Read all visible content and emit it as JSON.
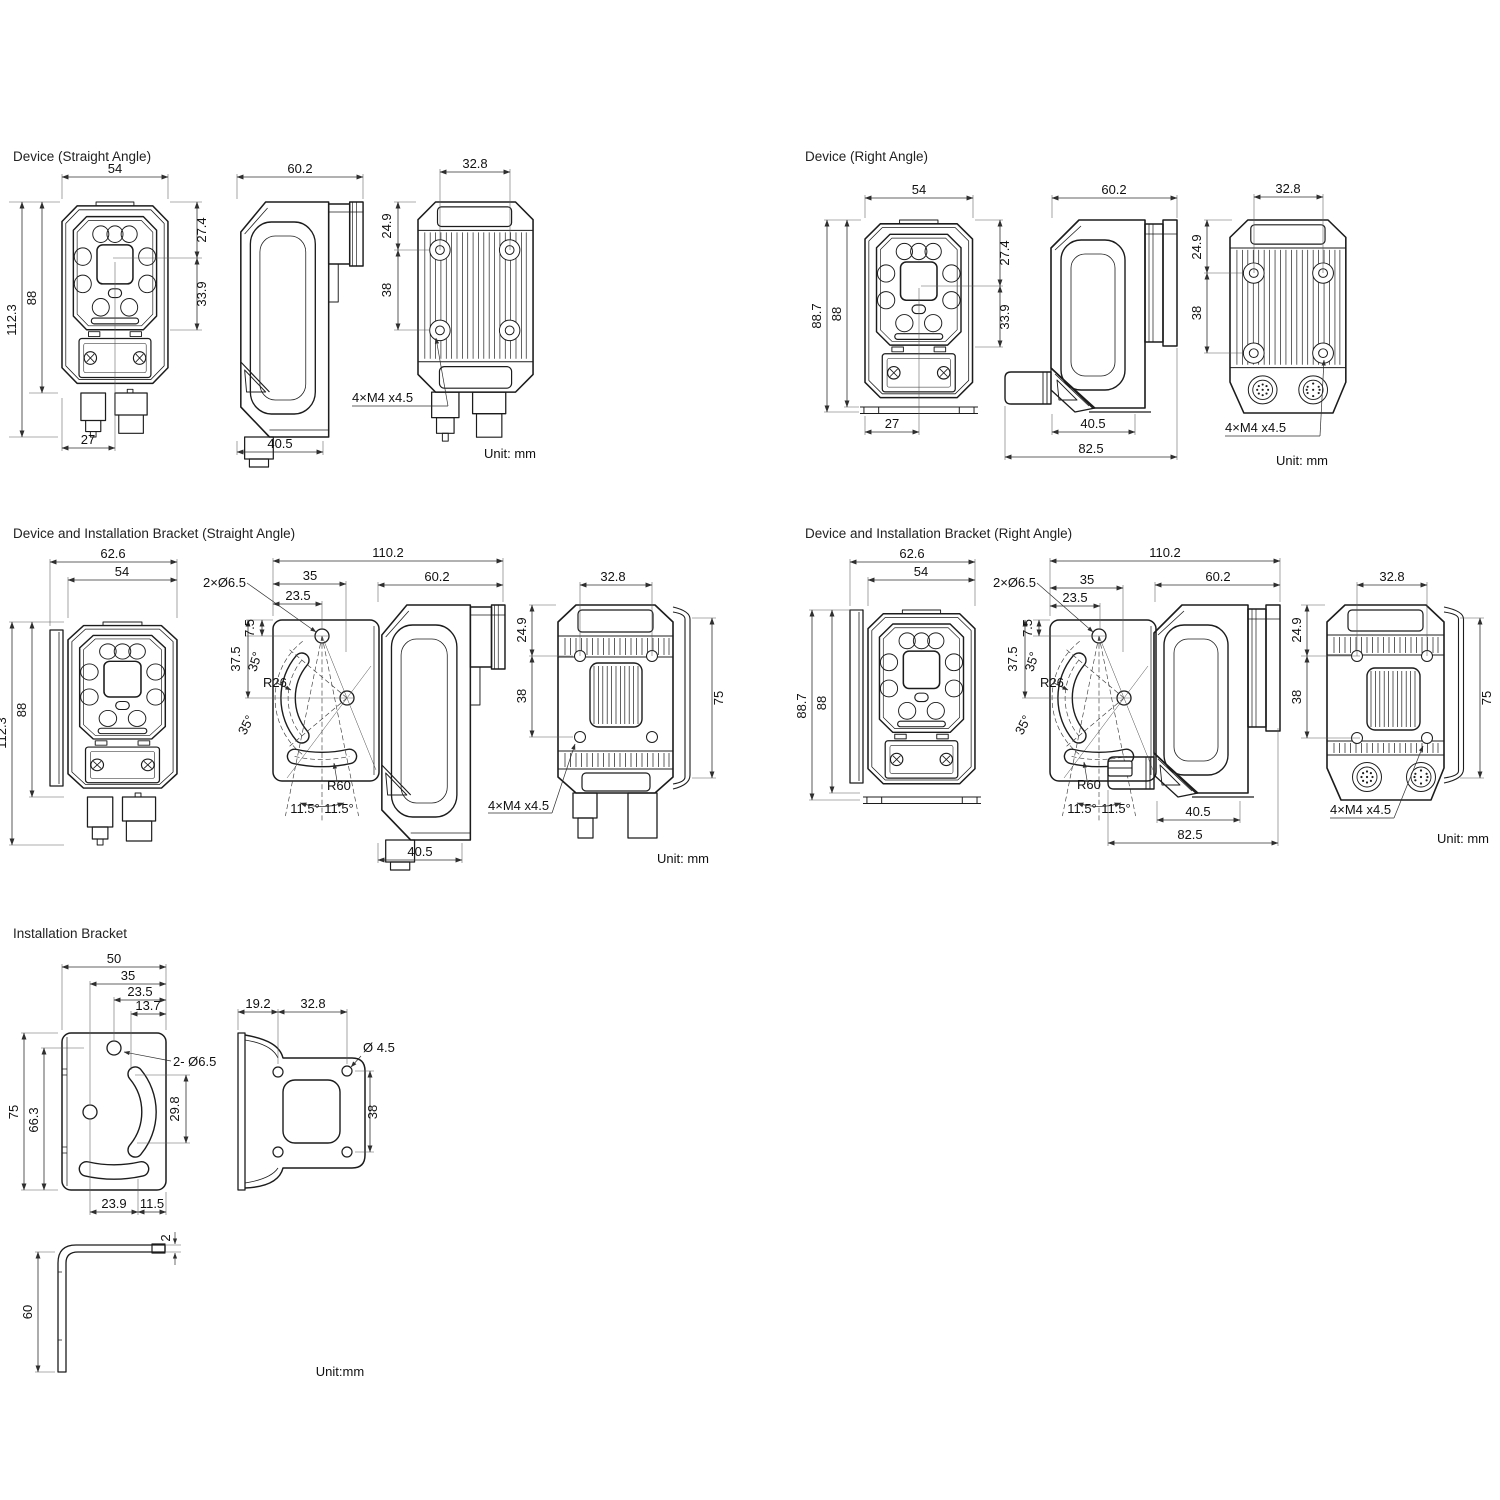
{
  "s1": {
    "title": "Device (Straight Angle)",
    "w": "54",
    "depth": "60.2",
    "back_w": "32.8",
    "lens_top": "27.4",
    "lens_bot": "33.9",
    "hole_top": "24.9",
    "hole_v": "38",
    "body_h": "88",
    "total_h": "112.3",
    "conn_x": "27",
    "depth_bot": "40.5",
    "thread": "4×M4 x4.5",
    "unit": "Unit: mm"
  },
  "s2": {
    "title": "Device (Right Angle)",
    "w": "54",
    "depth": "60.2",
    "back_w": "32.8",
    "lens_top": "27.4",
    "lens_bot": "33.9",
    "hole_top": "24.9",
    "hole_v": "38",
    "body_h": "88",
    "total_h": "88.7",
    "conn_x": "27",
    "depth_bot": "40.5",
    "overall_d": "82.5",
    "thread": "4×M4 x4.5",
    "unit": "Unit: mm"
  },
  "s3": {
    "title": "Device and Installation Bracket (Straight Angle)",
    "bracket_w": "62.6",
    "w": "54",
    "total_h": "112.3",
    "body_h": "88",
    "overall": "110.2",
    "holes": "2×Ø6.5",
    "hole_x": "35",
    "hole_x2": "23.5",
    "hole_y": "7.5",
    "hole_y2": "37.5",
    "ang_a": "35°",
    "ang_b": "35°",
    "r26": "R26",
    "r60": "R60",
    "ang_c": "11.5°",
    "ang_d": "11.5°",
    "depth": "60.2",
    "depth_bot": "40.5",
    "back_w": "32.8",
    "hole_top": "24.9",
    "hole_v": "38",
    "bracket_h": "75",
    "thread": "4×M4 x4.5",
    "unit": "Unit: mm"
  },
  "s4": {
    "title": "Device and Installation Bracket (Right Angle)",
    "bracket_w": "62.6",
    "w": "54",
    "total_h": "88.7",
    "body_h": "88",
    "overall": "110.2",
    "holes": "2×Ø6.5",
    "hole_x": "35",
    "hole_x2": "23.5",
    "hole_y": "7.5",
    "hole_y2": "37.5",
    "ang_a": "35°",
    "ang_b": "35°",
    "r26": "R26",
    "r60": "R60",
    "ang_c": "11.5°",
    "ang_d": "11.5°",
    "depth": "60.2",
    "depth_bot": "40.5",
    "overall_d": "82.5",
    "back_w": "32.8",
    "hole_top": "24.9",
    "hole_v": "38",
    "bracket_h": "75",
    "thread": "4×M4 x4.5",
    "unit": "Unit: mm"
  },
  "s5": {
    "title": "Installation Bracket",
    "w": "50",
    "hole_x": "35",
    "hole_x2": "23.5",
    "slot_x": "13.7",
    "holes": "2- Ø6.5",
    "h": "75",
    "h2": "66.3",
    "slot_len": "29.8",
    "slot_bot_a": "23.9",
    "slot_bot_b": "11.5",
    "flange": "19.2",
    "holes_w": "32.8",
    "dia": "Ø 4.5",
    "holes_v": "38",
    "leg": "60",
    "thk": "2",
    "unit": "Unit:mm"
  }
}
